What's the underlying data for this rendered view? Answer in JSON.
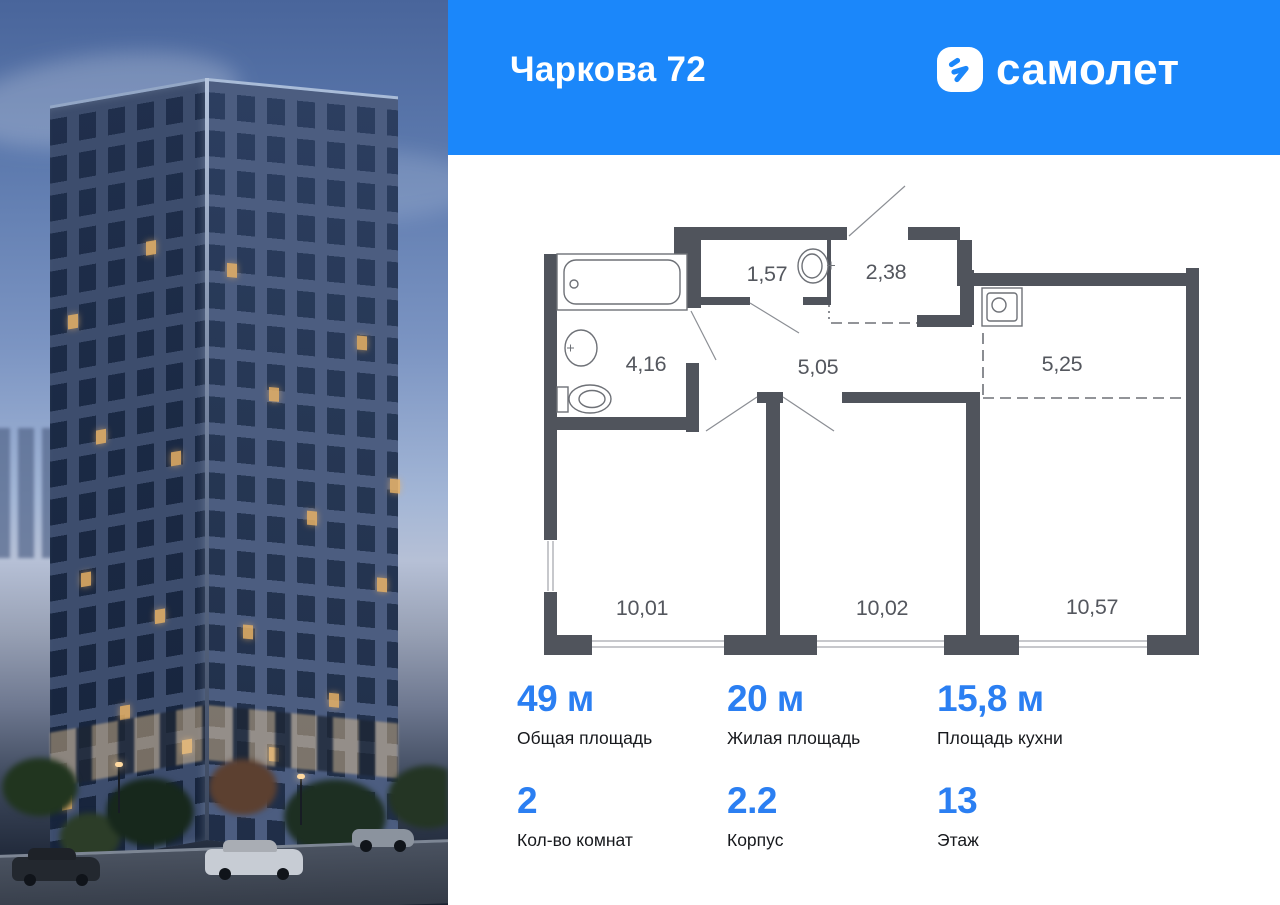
{
  "header": {
    "title": "Чаркова 72",
    "brand": "самолет"
  },
  "colors": {
    "header_bg": "#1b87fa",
    "accent_numbers": "#2b7ff2",
    "plan_walls": "#50545c",
    "logo_badge_bg": "#ffffff",
    "logo_arrow": "#1b87fa"
  },
  "floor_plan": {
    "rooms": [
      {
        "id": "hall-entry",
        "area": "1,57"
      },
      {
        "id": "wardrobe",
        "area": "2,38"
      },
      {
        "id": "bathroom",
        "area": "4,16"
      },
      {
        "id": "corridor",
        "area": "5,05"
      },
      {
        "id": "kitchen-zone",
        "area": "5,25"
      },
      {
        "id": "bedroom-1",
        "area": "10,01"
      },
      {
        "id": "bedroom-2",
        "area": "10,02"
      },
      {
        "id": "living-kitchen",
        "area": "10,57"
      }
    ]
  },
  "stats": [
    {
      "value": "49 м",
      "label": "Общая площадь"
    },
    {
      "value": "20 м",
      "label": "Жилая площадь"
    },
    {
      "value": "15,8 м",
      "label": "Площадь кухни"
    },
    {
      "value": "2",
      "label": "Кол-во комнат"
    },
    {
      "value": "2.2",
      "label": "Корпус"
    },
    {
      "value": "13",
      "label": "Этаж"
    }
  ]
}
